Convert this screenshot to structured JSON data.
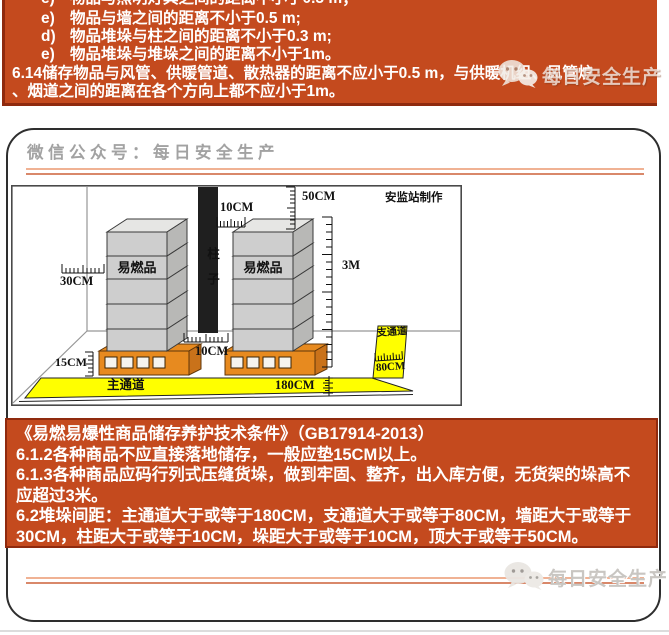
{
  "top_banner": {
    "clipped_item": {
      "marker": "e)",
      "text": "物品与照明灯具之间的距离不小于0.5 m；"
    },
    "items": [
      {
        "marker": "e)",
        "text": "物品与墙之间的距离不小于0.5 m;"
      },
      {
        "marker": "d)",
        "text": "物品堆垛与柱之间的距离不小于0.3 m;"
      },
      {
        "marker": "e)",
        "text": "物品堆垛与堆垛之间的距离不小于1m。"
      }
    ],
    "para_lines": [
      "6.14储存物品与风管、供暖管道、散热器的距离不应小于0.5 m，与供暖机组、风管炉",
      "、烟道之间的距离在各个方向上都不应小于1m。"
    ]
  },
  "watermark": {
    "icon": "wechat-logo",
    "text": "每日安全生产"
  },
  "page": {
    "header": "微信公众号：每日安全生产"
  },
  "diagram": {
    "credit": "安监站制作",
    "column_label": "柱子",
    "goods_label": "易燃品",
    "wall_gap": "30CM",
    "ceiling_gap": "50CM",
    "column_gap": "10CM",
    "stack_height": "3M",
    "pallet_height": "15CM",
    "stack_gap": "10CM",
    "main_aisle_label": "主通道",
    "main_aisle_width": "180CM",
    "branch_aisle_label": "支通道",
    "branch_aisle_width": "80CM"
  },
  "bottom_banner": {
    "rows": [
      "《易燃易爆性商品储存养护技术条件》（GB17914-2013）",
      "6.1.2各种商品不应直接落地储存，一般应垫15CM以上。",
      "6.1.3各种商品应码行列式压缝货垛，做到牢固、整齐，出入库方便，无货架的垛高不",
      "应超过3米。",
      "6.2堆垛间距：主通道大于或等于180CM，支通道大于或等于80CM，墙距大于或等于",
      "30CM，柱距大于或等于10CM，垛距大于或等于10CM，顶大于或等于50CM。"
    ]
  },
  "colors": {
    "banner_orange": "#c44a1e",
    "banner_border": "#8f2a0e",
    "accent_line_light": "#f0b294",
    "accent_line_dark": "#d9886a",
    "aisle_yellow": "#ffff00",
    "pallet_orange": "#e78a1f"
  }
}
